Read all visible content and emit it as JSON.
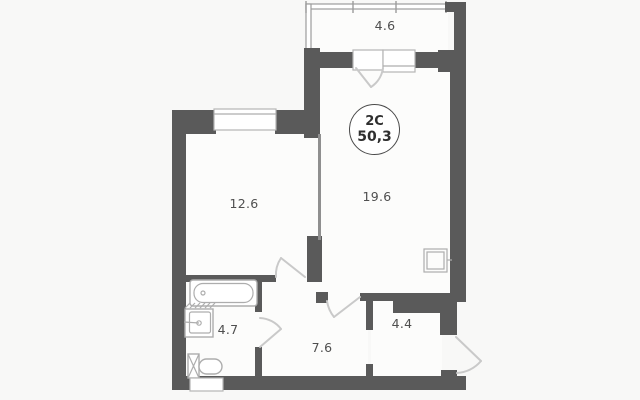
{
  "floorplan": {
    "badge": {
      "layout_code": "2C",
      "total_area": "50,3"
    },
    "rooms": [
      {
        "name": "balcony",
        "area_label": "4.6"
      },
      {
        "name": "bedroom",
        "area_label": "12.6"
      },
      {
        "name": "living-room",
        "area_label": "19.6"
      },
      {
        "name": "bathroom",
        "area_label": "4.7"
      },
      {
        "name": "hallway",
        "area_label": "7.6"
      },
      {
        "name": "entry-hall",
        "area_label": "4.4"
      }
    ],
    "colors": {
      "wall": "#5a5a5a",
      "bg": "#f8f8f7",
      "room": "#fcfcfb",
      "line": "#c9c9c9",
      "thin": "#b5b5b5",
      "fixture": "#adadad",
      "partition": "#8f8f8f",
      "text": "#4f4f4f",
      "badge": "#4a4a4a"
    }
  }
}
